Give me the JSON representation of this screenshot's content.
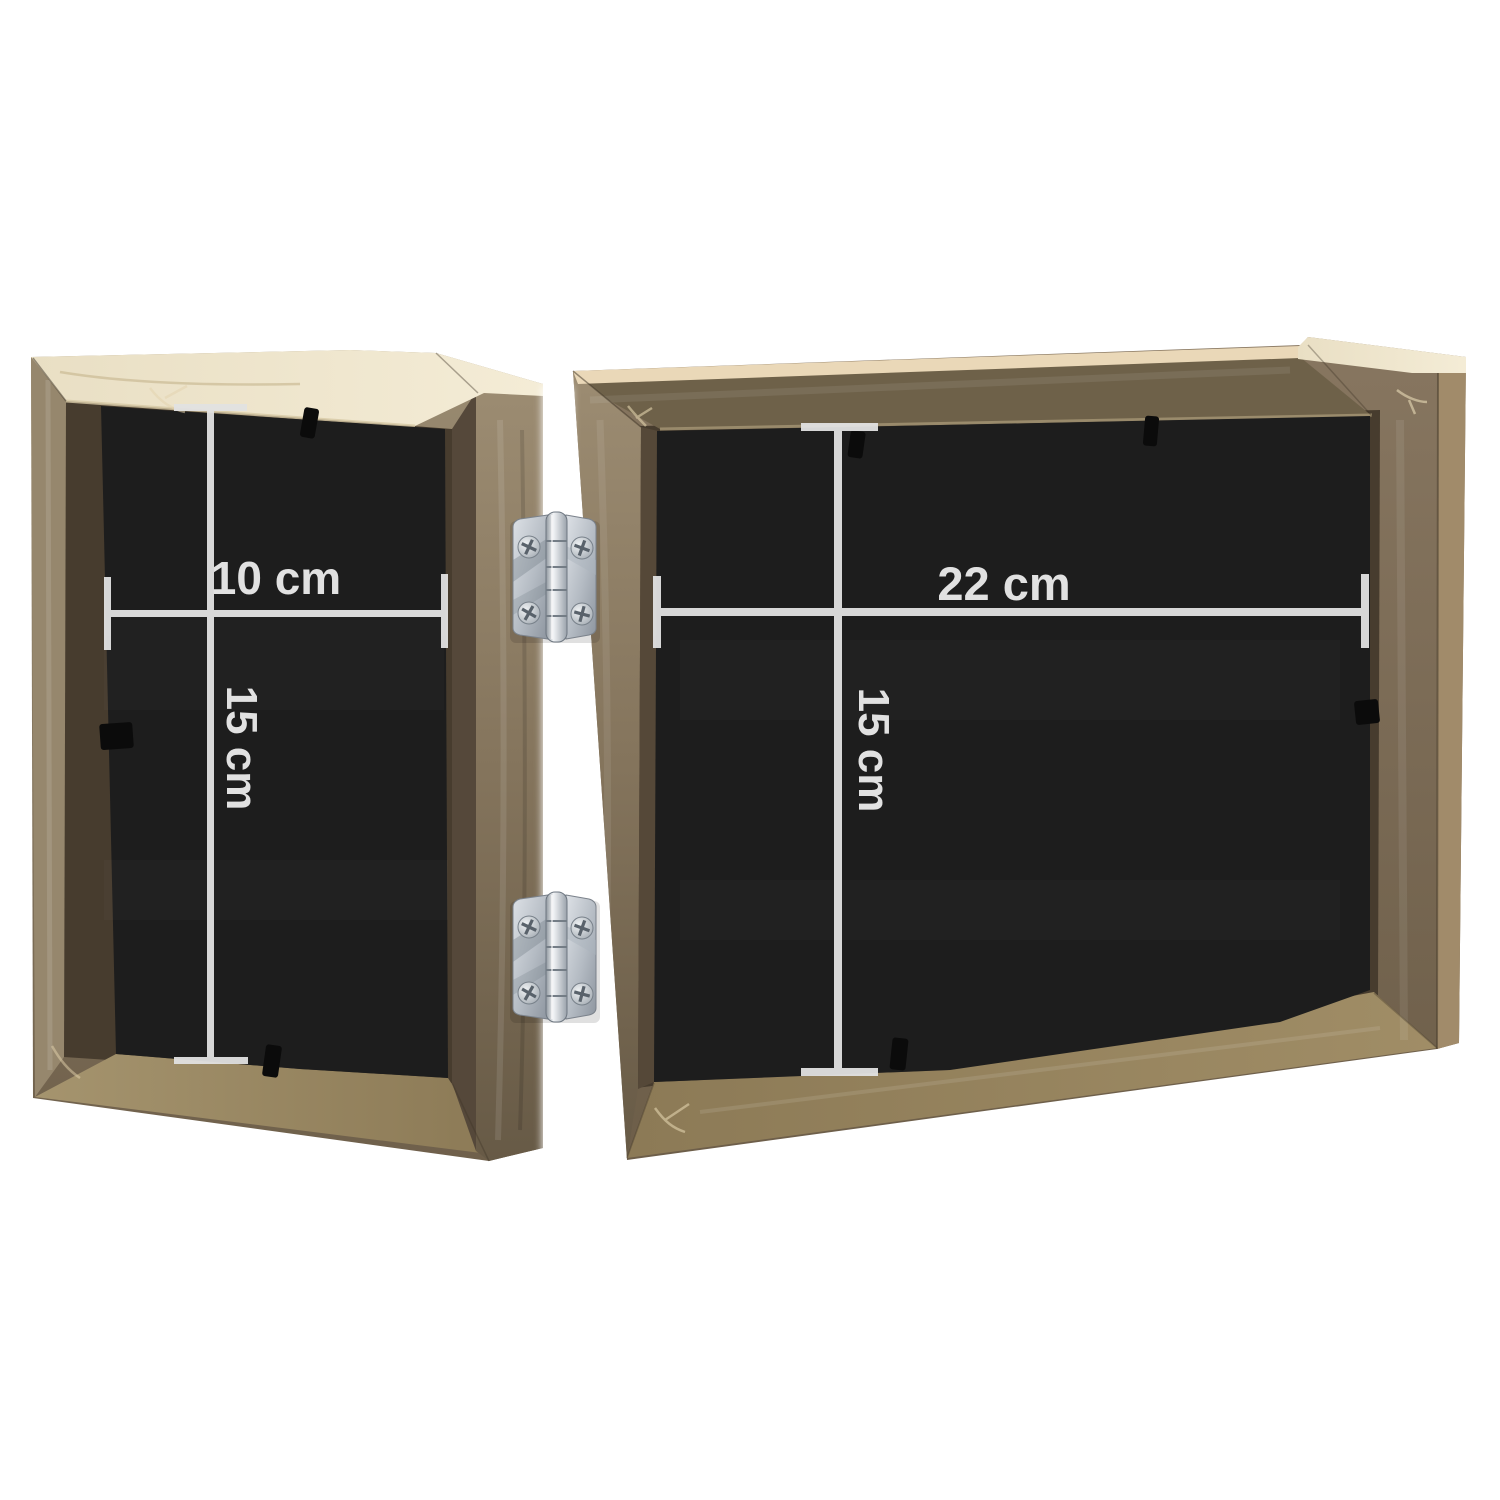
{
  "image": {
    "background_color": "#ffffff",
    "subject": "folding-double-photo-frame-back-view"
  },
  "product": {
    "panels": [
      {
        "id": "left",
        "width_label": "10 cm",
        "height_label": "15 cm"
      },
      {
        "id": "right",
        "width_label": "22 cm",
        "height_label": "15 cm"
      }
    ],
    "hinge_icons": [
      "hinge-icon-top",
      "hinge-icon-bottom"
    ]
  },
  "annotation_style": {
    "line_color": "#e2e2e2",
    "text_color": "#ececec"
  },
  "palette": {
    "wood_light": "#9c8d74",
    "wood_mid": "#7a6b52",
    "wood_dark": "#64563f",
    "wood_top_cream": "#f0e8d0",
    "interior_shadow": "#473c2e",
    "floor_wood": "#97855f",
    "backing_black": "#1d1d1d",
    "hinge_silver": "#c9ced6",
    "hinge_shadow": "#8d959f"
  }
}
